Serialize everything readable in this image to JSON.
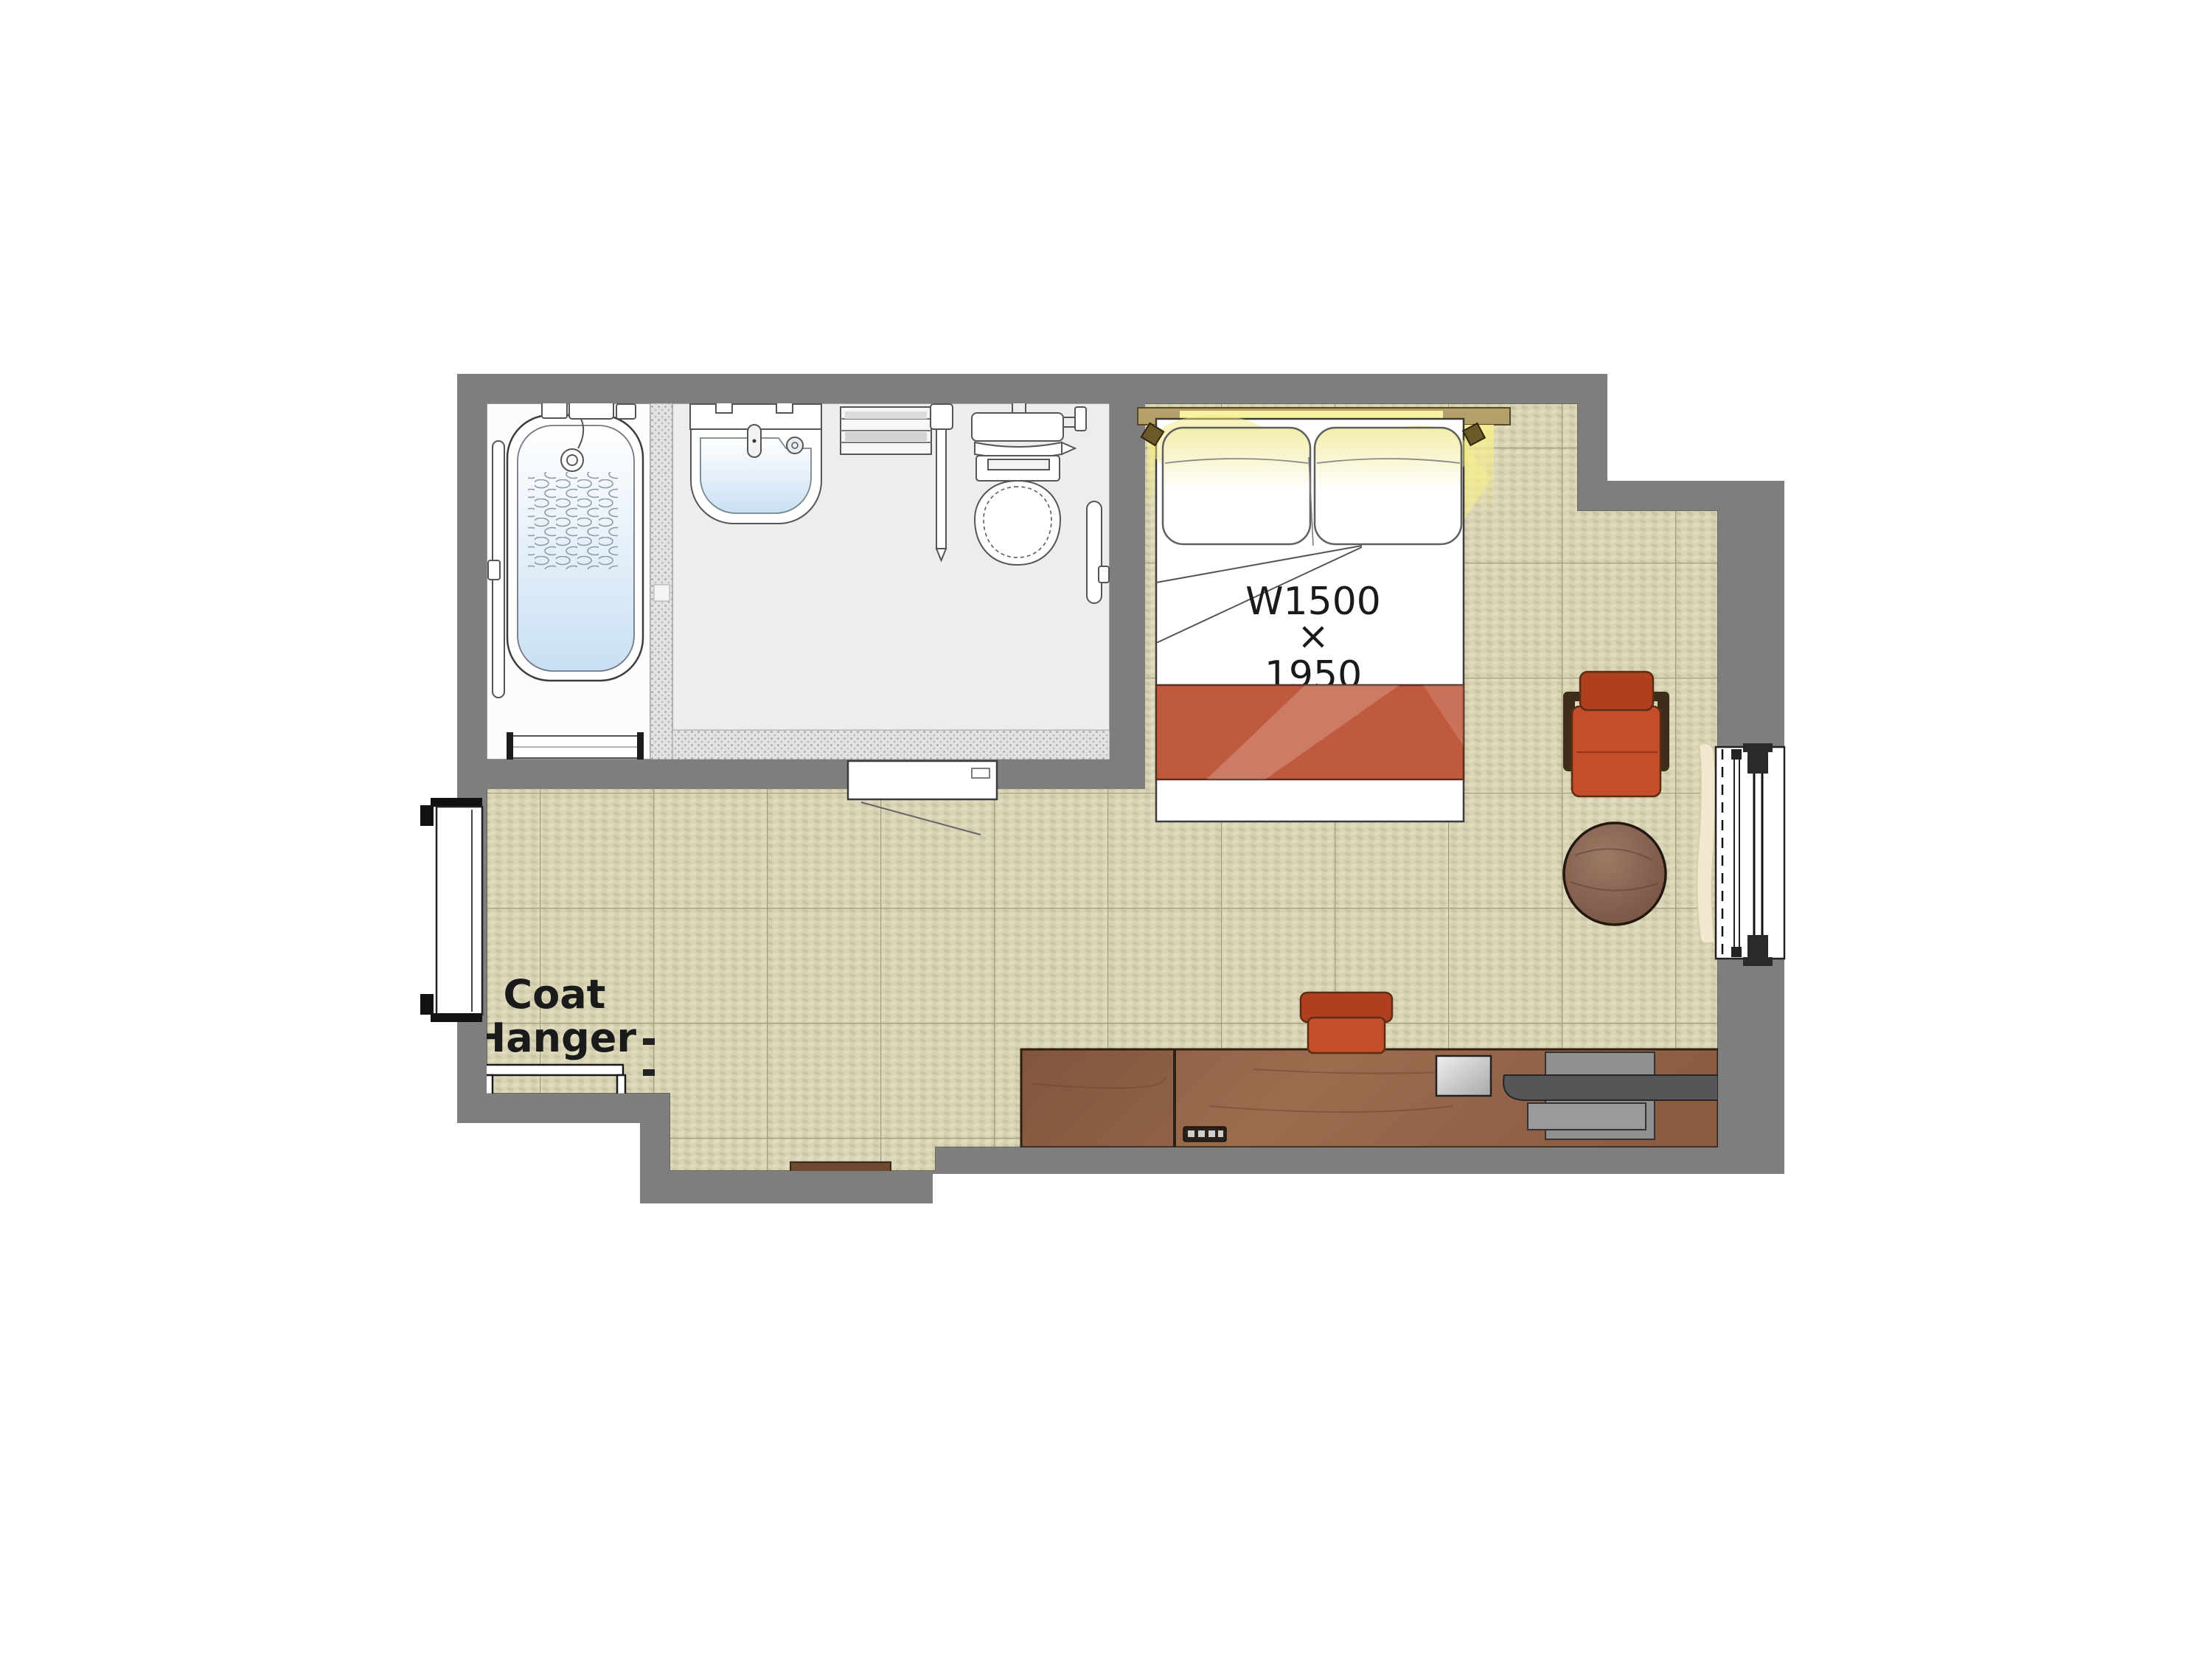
{
  "document": {
    "type": "floor-plan",
    "subject": "hotel-guest-room"
  },
  "labels": {
    "bed_width": "W1500",
    "dimension_separator": "×",
    "bed_depth": "1950",
    "coat_hanger_line1": "Coat",
    "coat_hanger_line2": "Hanger"
  },
  "colors": {
    "wall": "#7e7e7e",
    "floor": "#d8d3b4",
    "floor_dot": "#c2bc9a",
    "floor_grid": "#a29c80",
    "bath_floor": "#ededed",
    "tub_floor": "#fcfcfc",
    "line": "#3c3c3c",
    "glow": "#f6ee8d",
    "headboard": "#b5a06b",
    "blanket": "#c05a3e",
    "chair": "#c44e2b",
    "chair_dark": "#b03f20",
    "chair_frame": "#3f2d1c",
    "wood_desk": "#8a5c42",
    "wood_desk2": "#9c6c4e",
    "wood_table": "#8a6753",
    "door": "#6f4a33",
    "curtain": "#f0e9cf",
    "tv": "#565656",
    "label": "#1a1a1a"
  }
}
